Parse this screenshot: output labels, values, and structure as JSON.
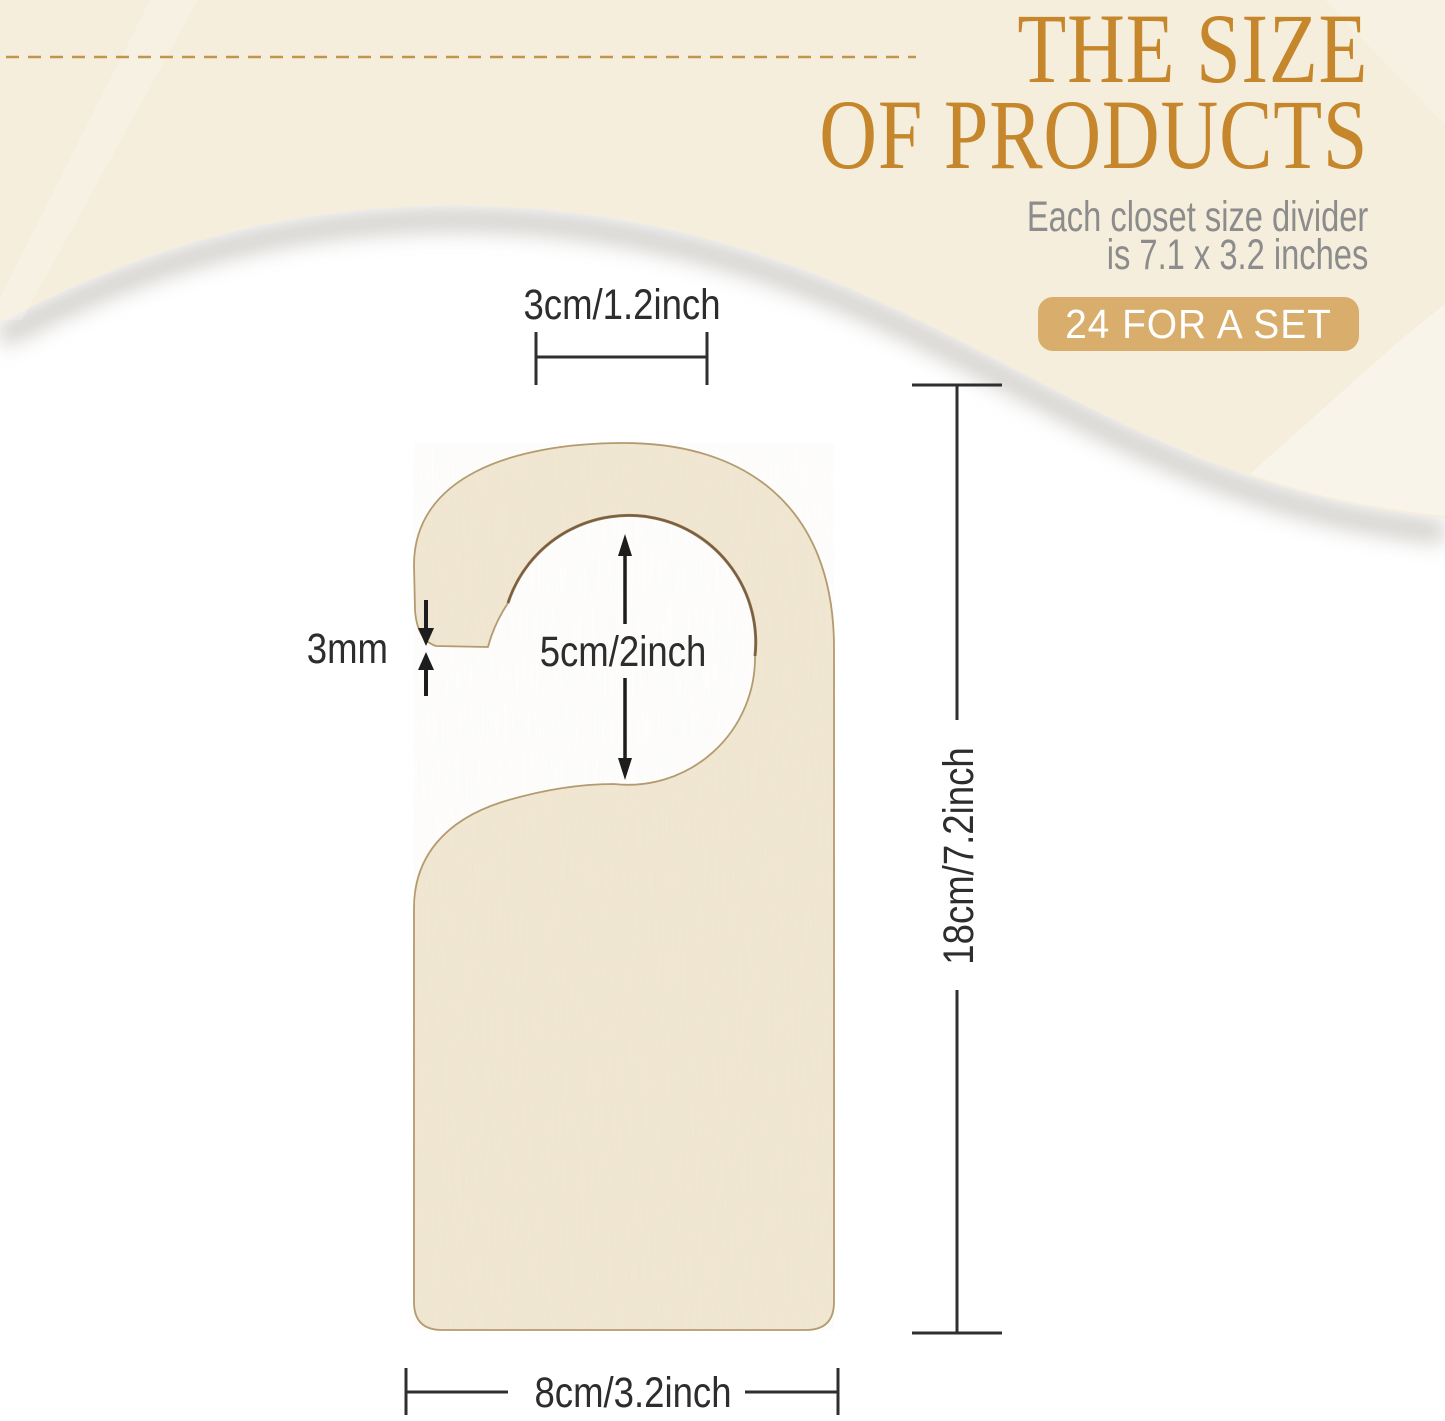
{
  "header": {
    "title_line1": "THE SIZE",
    "title_line2": "OF PRODUCTS",
    "subtitle_line1": "Each closet size divider",
    "subtitle_line2": "is 7.1 x 3.2 inches",
    "badge_label": "24 FOR A SET"
  },
  "diagram": {
    "product": "wooden closet size divider door hanger",
    "dimensions": {
      "hook_top_width": "3cm/1.2inch",
      "board_thickness": "3mm",
      "hole_diameter": "5cm/2inch",
      "total_height": "18cm/7.2inch",
      "total_width": "8cm/3.2inch"
    }
  },
  "colors": {
    "title_gold": "#c5862c",
    "badge_tan": "#d9ad6b",
    "badge_text": "#ffffff",
    "subtitle_gray": "#8c8c8c",
    "cream_wave": "#f5eedc",
    "wood_fill": "#f1e8d4",
    "wood_outline": "#a98a58",
    "hole_rim_brown": "#6b4a28",
    "dashed_line_gold": "#c2954c",
    "dimension_line": "#2f2f2f",
    "background": "#ffffff"
  }
}
